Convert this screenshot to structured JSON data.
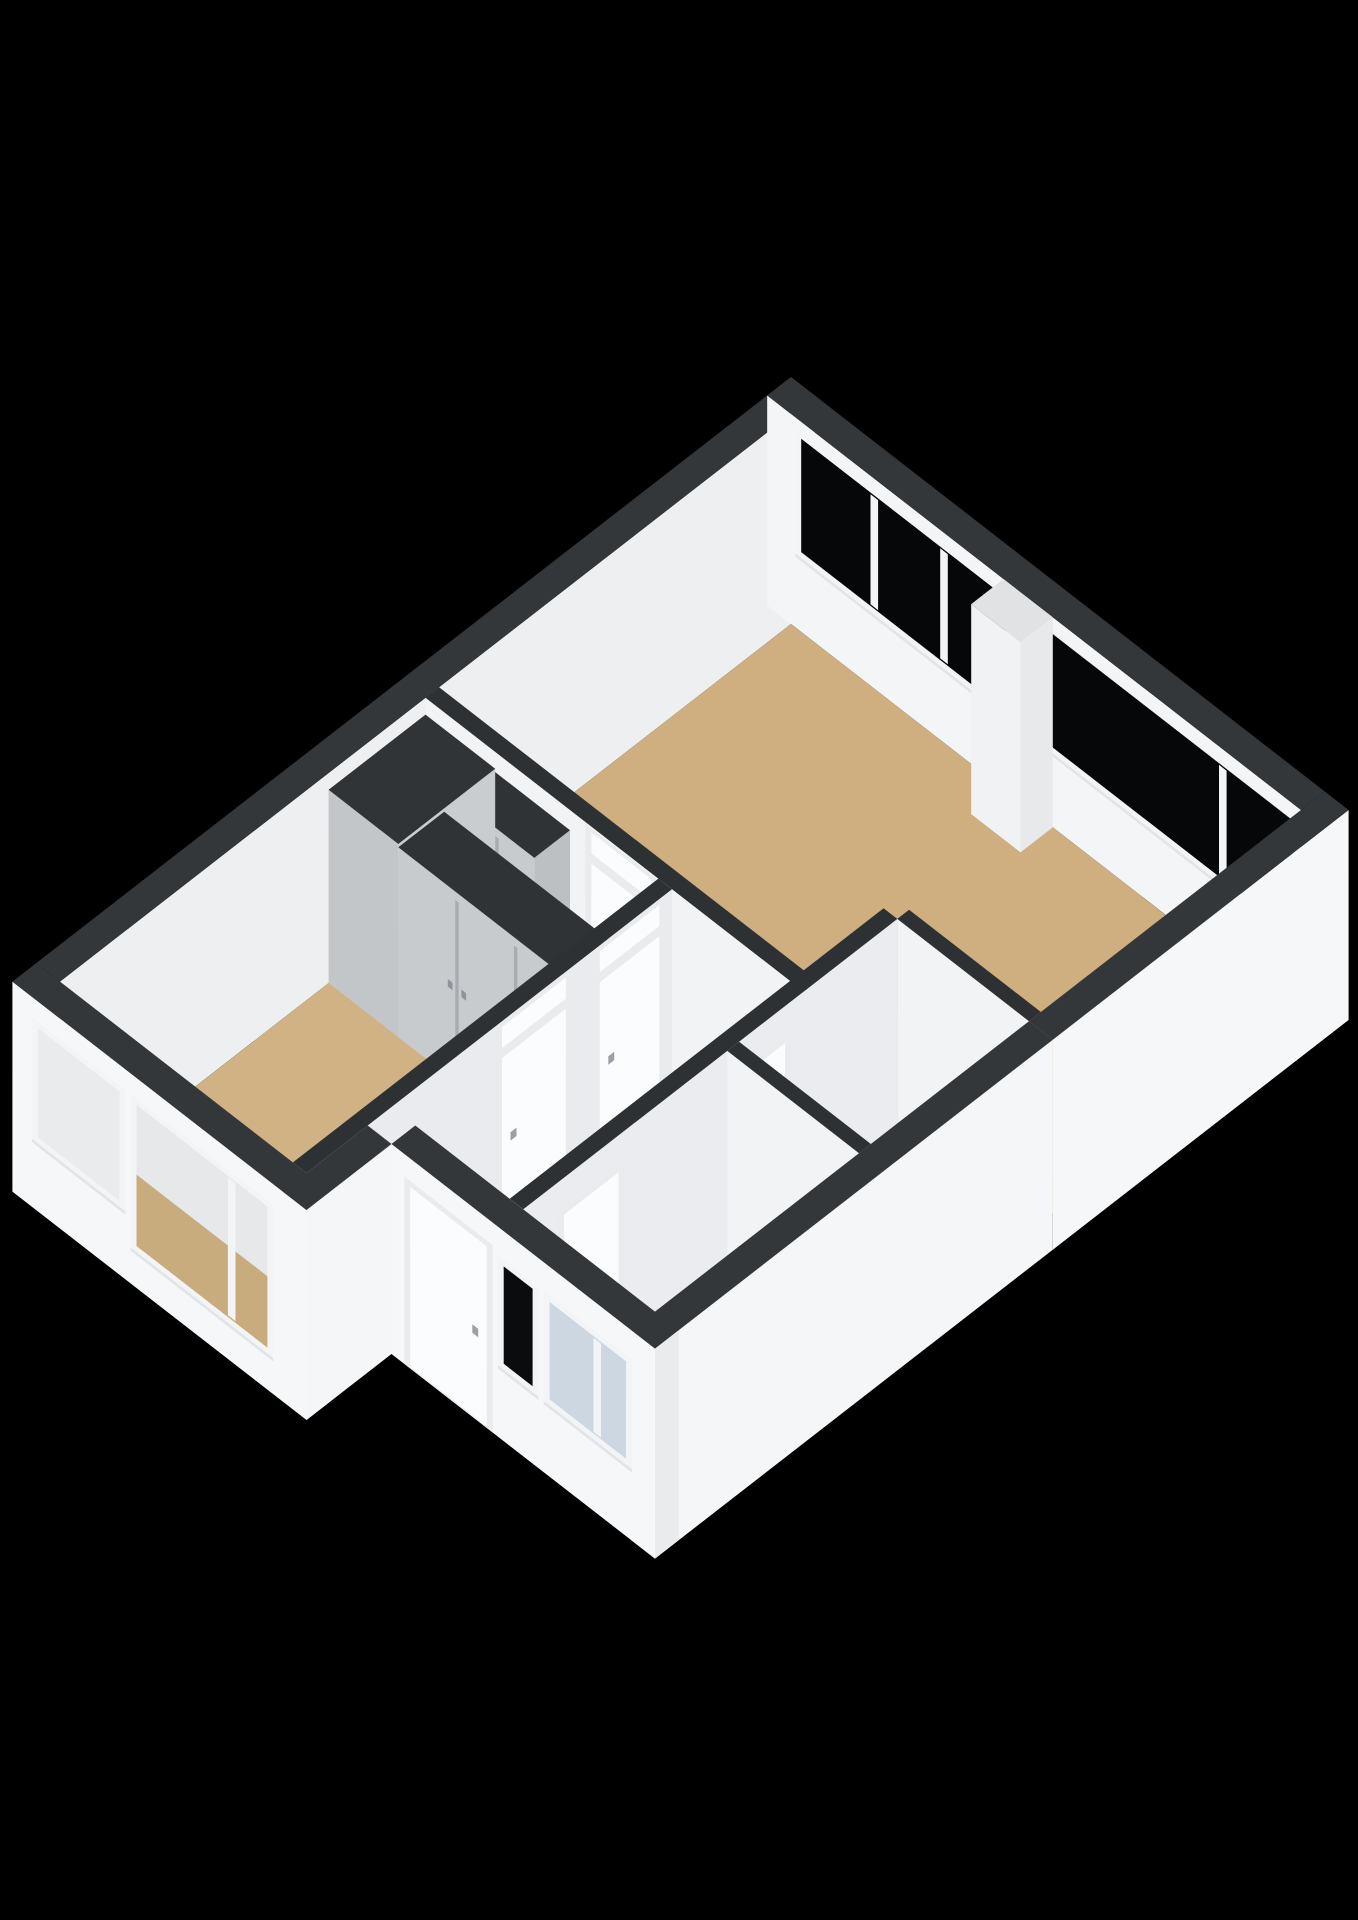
{
  "view": {
    "kind": "3d-floorplan-render",
    "background": "#000000",
    "width": 1358,
    "height": 1920
  },
  "projection": {
    "x0": 791,
    "y0": 624,
    "dx": 85,
    "dy": 66,
    "vz": 84,
    "wall_height": 2.5
  },
  "palette": {
    "background": "#000000",
    "cap_exterior": "#33373a",
    "cap_interior": "#2e3134",
    "wall_bright": "#f6f7f8",
    "wall_interior": "#eef0f2",
    "floor_tan": "#cfae80",
    "floor_gray": "#cbcfd2",
    "floor_blue": "#c3d1df",
    "closet_gray": "#c7cbce",
    "glass_dark": "#060708",
    "glass_light": "#ccd7e1",
    "frame_white": "#f3f4f6",
    "door_leaf": "#fbfcfd"
  },
  "scene": [
    {
      "op": "wall",
      "name": "wall-nw-exterior",
      "axis": "b",
      "c": 0,
      "t": 0.28,
      "from": -0.28,
      "to": 8.6,
      "h": 2.5,
      "face": "#edeff1",
      "cap": "#33373a"
    },
    {
      "op": "wall",
      "name": "wall-ne-exterior",
      "axis": "a",
      "c": 0,
      "t": 0.28,
      "from": -0.28,
      "to": 6.0,
      "h": 2.5,
      "face": "#f4f5f7",
      "cap": "#33373a"
    },
    {
      "op": "window",
      "name": "living-room-window-band-1",
      "axis": "a",
      "c": 0,
      "from": 0.12,
      "to": 2.52,
      "z1": 0.95,
      "z2": 2.3,
      "glass": "#060708",
      "frame": "#f3f4f6",
      "mullions": [
        0.98,
        1.8
      ]
    },
    {
      "op": "window",
      "name": "living-room-window-band-2",
      "axis": "a",
      "c": 0,
      "from": 3.06,
      "to": 5.9,
      "z1": 0.95,
      "z2": 2.3,
      "glass": "#060708",
      "frame": "#f3f4f6",
      "mullions": [
        5.08
      ]
    },
    {
      "op": "floor",
      "name": "living-room-floor",
      "color": "#cfae80",
      "pts": [
        [
          0,
          0
        ],
        [
          6,
          0
        ],
        [
          6,
          3.2
        ],
        [
          4.45,
          3.2
        ],
        [
          4.45,
          4.3
        ],
        [
          0,
          4.3
        ]
      ]
    },
    {
      "op": "floor",
      "name": "storage-room-floor",
      "color": "#c7cacd",
      "pts": [
        [
          4.45,
          3.2
        ],
        [
          6,
          3.2
        ],
        [
          6,
          5.2
        ],
        [
          4.45,
          5.2
        ]
      ]
    },
    {
      "op": "floor",
      "name": "corridor-floor",
      "color": "#c9a97b",
      "pts": [
        [
          0,
          4.3
        ],
        [
          2.9,
          4.3
        ],
        [
          2.9,
          4.9
        ],
        [
          0,
          4.9
        ]
      ]
    },
    {
      "op": "floor",
      "name": "hall-floor",
      "color": "#cbcfd2",
      "pts": [
        [
          2.9,
          4.3
        ],
        [
          4.45,
          4.3
        ],
        [
          4.45,
          7.6
        ],
        [
          2.9,
          7.6
        ]
      ]
    },
    {
      "op": "floor",
      "name": "bathroom-floor",
      "color": "#c3d1df",
      "pts": [
        [
          4.45,
          5.2
        ],
        [
          6,
          5.2
        ],
        [
          6,
          7.6
        ],
        [
          4.45,
          7.6
        ]
      ]
    },
    {
      "op": "floor",
      "name": "bedroom-floor",
      "color": "#d1b284",
      "pts": [
        [
          0,
          4.9
        ],
        [
          2.9,
          4.9
        ],
        [
          2.9,
          8.6
        ],
        [
          0,
          8.6
        ]
      ]
    },
    {
      "op": "block",
      "name": "window-pier",
      "a1": 2.5,
      "a2": 3.08,
      "b1": 0,
      "b2": 0.38,
      "h": 2.5,
      "faceA": "#e7e9eb",
      "faceB": "#f1f2f4",
      "cap": "#e0e2e4"
    },
    {
      "op": "wall",
      "name": "storage-north-wall",
      "axis": "a",
      "c": 3.2,
      "t": 0.14,
      "from": 4.45,
      "to": 6.0,
      "h": 2.5,
      "face": "#f2f3f5",
      "cap": "#2e3134"
    },
    {
      "op": "wall",
      "name": "living-room-south-wall",
      "axis": "a",
      "c": 4.3,
      "t": 0.16,
      "from": 0,
      "to": 4.45,
      "h": 2.5,
      "face": "#f2f3f5",
      "cap": "#2e3134"
    },
    {
      "op": "door",
      "name": "living-room-door",
      "axis": "a",
      "c": 4.3,
      "from": 1.95,
      "to": 2.65,
      "h2": 2.06,
      "transom": true,
      "frame": "#e9ebed",
      "leaf": "#fbfcfd",
      "handle": "#9aa0a5",
      "transom_glass": "#fbfcfe"
    },
    {
      "op": "block",
      "name": "corridor-closet",
      "a1": 0.82,
      "a2": 1.7,
      "b1": 4.3,
      "b2": 4.72,
      "h": 2.26,
      "faceA": "#bcc0c3",
      "faceB": "#c7cbce",
      "cap": "#2f3336",
      "seams": [
        1.26
      ],
      "seam_color": "#a7acb0"
    },
    {
      "op": "block",
      "name": "corner-closet",
      "a1": 0,
      "a2": 0.82,
      "b1": 4.3,
      "b2": 5.44,
      "h": 2.3,
      "faceA": "#c9cdd0",
      "faceB": "#c2c6c9",
      "cap": "#303437"
    },
    {
      "op": "block",
      "name": "bedroom-wardrobe",
      "a1": 0.82,
      "a2": 2.88,
      "b1": 4.9,
      "b2": 5.44,
      "h": 2.26,
      "faceA": "#b9bdc0",
      "faceB": "#c7cbce",
      "cap": "#2f3336",
      "seams": [
        1.51,
        2.2
      ],
      "seam_color": "#a7acb0",
      "knobs": [
        1.43,
        1.59,
        2.12,
        2.28
      ],
      "knob_color": "#8e9499"
    },
    {
      "op": "wall",
      "name": "bedroom-east-wall",
      "axis": "b",
      "c": 2.9,
      "t": 0.16,
      "from": 4.3,
      "to": 8.6,
      "h": 2.5,
      "face": "#e9ebee",
      "cap": "#2e3134"
    },
    {
      "op": "door",
      "name": "corridor-door",
      "axis": "b",
      "c": 2.9,
      "from": 4.45,
      "to": 5.15,
      "h2": 2.06,
      "transom": true,
      "frame": "#e9ebed",
      "leaf": "#fbfcfd",
      "handle": "#9aa0a5",
      "transom_glass": "#fbfcfe"
    },
    {
      "op": "door",
      "name": "bedroom-door",
      "axis": "b",
      "c": 2.9,
      "from": 5.55,
      "to": 6.3,
      "h2": 2.06,
      "transom": true,
      "frame": "#e9ebed",
      "leaf": "#fbfcfd",
      "handle": "#9aa0a5",
      "transom_glass": "#fbfcfe"
    },
    {
      "op": "wall",
      "name": "hall-east-wall",
      "axis": "b",
      "c": 4.45,
      "t": 0.16,
      "from": 3.2,
      "to": 7.6,
      "h": 2.5,
      "face": "#eaecef",
      "cap": "#2e3134"
    },
    {
      "op": "door",
      "name": "storage-door",
      "axis": "b",
      "c": 4.45,
      "from": 4.52,
      "to": 5.06,
      "h2": 2.06,
      "transom": false,
      "frame": "#e9ebed",
      "leaf": "#fbfcfd",
      "handle": "#9aa0a5"
    },
    {
      "op": "door",
      "name": "bathroom-door",
      "axis": "b",
      "c": 4.45,
      "from": 6.48,
      "to": 7.12,
      "h2": 2.06,
      "transom": false,
      "frame": "#e9ebed",
      "leaf": "#fbfcfd",
      "handle": "#9aa0a5"
    },
    {
      "op": "wall",
      "name": "bathroom-north-wall",
      "axis": "a",
      "c": 5.2,
      "t": 0.14,
      "from": 4.45,
      "to": 6.0,
      "h": 2.5,
      "face": "#f2f3f5",
      "cap": "#2e3134"
    },
    {
      "op": "wall",
      "name": "se-exterior-wall-upper",
      "axis": "b",
      "c": 6.28,
      "t": 0.28,
      "from": -0.28,
      "to": 3.2,
      "h": 2.5,
      "face": "#f6f7f8",
      "cap": "#33373a"
    },
    {
      "op": "wall",
      "name": "se-exterior-wall-lower",
      "axis": "b",
      "c": 6.28,
      "t": 0.28,
      "from": 3.2,
      "to": 7.88,
      "h": 2.5,
      "face": "#f5f6f8",
      "cap": "#33373a",
      "end": "#e9ebed"
    },
    {
      "op": "wall",
      "name": "bedroom-sw-exterior-wall",
      "axis": "a",
      "c": 8.88,
      "t": 0.28,
      "from": -0.28,
      "to": 3.18,
      "h": 2.5,
      "face": "#f5f7f8",
      "cap": "#33373a",
      "end": "#e8eaec"
    },
    {
      "op": "window",
      "name": "bedroom-window-1",
      "axis": "a",
      "c": 8.88,
      "from": 0.02,
      "to": 0.98,
      "z1": 0.88,
      "z2": 2.18,
      "glass": "#e9ebed",
      "frame": "#f3f4f6",
      "mullions": []
    },
    {
      "op": "window",
      "name": "bedroom-window-2",
      "axis": "a",
      "c": 8.88,
      "from": 1.18,
      "to": 2.72,
      "z1": 0.5,
      "z2": 2.18,
      "glass": "#e6e8e9",
      "frame": "#f3f4f6",
      "mullions": [
        2.3
      ],
      "panes": [
        {
          "u1": 1.18,
          "u2": 2.72,
          "z1": 0.5,
          "z2": 1.35,
          "color": "#c9ac7e"
        }
      ]
    },
    {
      "op": "wall",
      "name": "wing-return-exterior-wall",
      "axis": "b",
      "c": 3.18,
      "t": 0.28,
      "from": 7.88,
      "to": 8.88,
      "h": 2.5,
      "face": "#f4f6f7",
      "cap": "#33373a"
    },
    {
      "op": "wall",
      "name": "wing-sw-exterior-wall",
      "axis": "a",
      "c": 7.88,
      "t": 0.28,
      "from": 3.18,
      "to": 6.28,
      "h": 2.5,
      "face": "#f6f7f8",
      "cap": "#33373a",
      "end": "#e9ebed"
    },
    {
      "op": "door",
      "name": "front-door",
      "axis": "a",
      "c": 7.88,
      "from": 3.4,
      "to": 4.3,
      "h2": 2.16,
      "transom": false,
      "frame": "#e9ebed",
      "leaf": "#fbfcfd",
      "handle": "#9aa0a5"
    },
    {
      "op": "window",
      "name": "entry-window",
      "axis": "a",
      "c": 7.88,
      "from": 4.5,
      "to": 4.84,
      "z1": 0.92,
      "z2": 2.08,
      "glass": "#0b0c0e",
      "frame": "#f3f4f6",
      "mullions": []
    },
    {
      "op": "window",
      "name": "bathroom-window",
      "axis": "a",
      "c": 7.88,
      "from": 5.04,
      "to": 5.94,
      "z1": 0.92,
      "z2": 2.08,
      "glass": "#ccd7e1",
      "frame": "#f3f4f6",
      "mullions": [
        5.6
      ]
    }
  ]
}
